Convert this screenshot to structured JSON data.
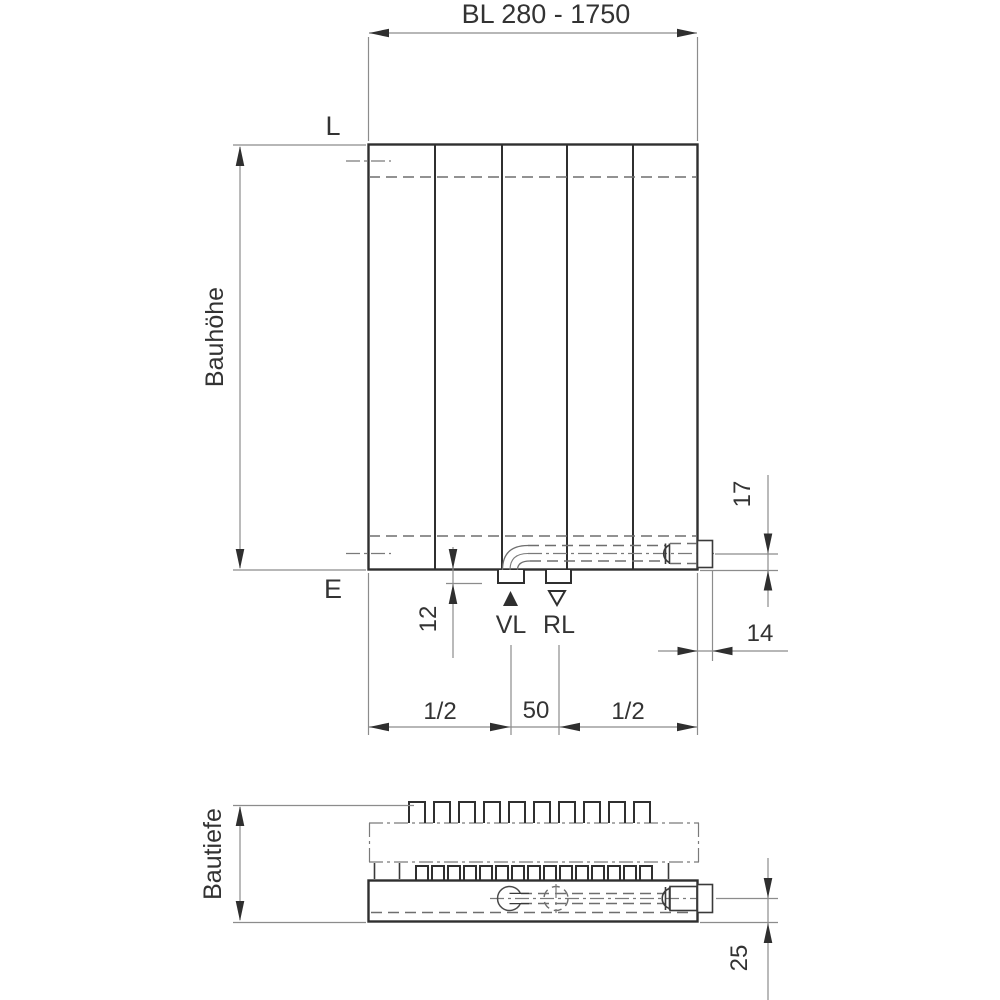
{
  "drawing": {
    "front_view": {
      "length_dim": "BL 280 - 1750",
      "top_label": "L",
      "bottom_label": "E",
      "height_label": "Bauhöhe",
      "stub_depth_dim": "12",
      "supply_label": "VL",
      "return_label": "RL",
      "left_half_dim": "1/2",
      "center_dim": "50",
      "right_half_dim": "1/2",
      "pipe_height_dim": "17",
      "side_offset_dim": "14"
    },
    "top_view": {
      "depth_label": "Bautiefe",
      "pipe_offset_dim": "25"
    },
    "colors": {
      "line": "#2f2f2f",
      "dimension_line": "#8c8c8c",
      "background": "#ffffff"
    }
  }
}
